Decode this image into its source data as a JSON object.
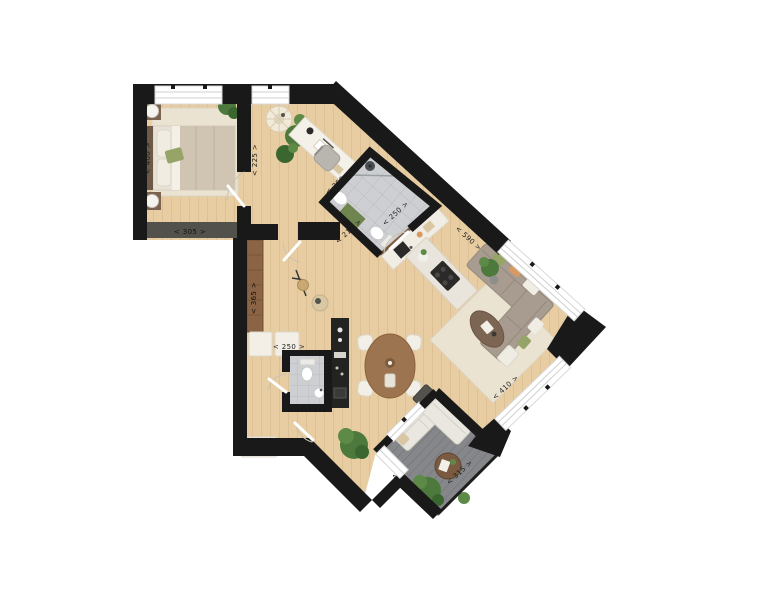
{
  "palette": {
    "wall": "#191919",
    "wood_floor": "#e8cda2",
    "tile": "#cdcfd2",
    "deck": "#85878a",
    "rug": "#ebe3d2",
    "furniture_wood": "#9c7450",
    "sofa": "#a79c8f",
    "white_furniture": "#f3efe7",
    "plant_green": "#4d7a3c",
    "accent_green": "#96a468",
    "accent_orange": "#d99a62",
    "label_color": "#1f1f1f"
  },
  "dimension_labels": {
    "bedroom_depth": "< 400 >",
    "bedroom_width": "< 305 >",
    "office_width": "< 225 >",
    "office_depth": "< 250 >",
    "bathroom_length": "< 250 >",
    "bathroom_width": "< 210 >",
    "hall_length": "< 365 >",
    "hall_width": "< 250 >",
    "living_length": "< 590 >",
    "living_width": "< 410 >",
    "balcony_length": "< 315 >",
    "balcony_width": "< 200 >"
  }
}
